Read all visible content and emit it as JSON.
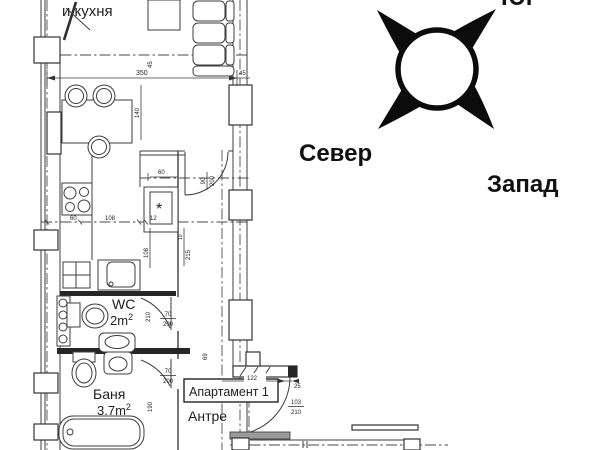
{
  "compass": {
    "north_label": "Север",
    "west_label": "Запад",
    "clipped_top_label": "Юг"
  },
  "plan": {
    "living_kitchen_label": "и кухня",
    "wc": {
      "name": "WC",
      "area_base": "2m",
      "area_exp": "2"
    },
    "bath": {
      "name": "Баня",
      "area_base": "3.7m",
      "area_exp": "2"
    },
    "apartment_label": "Апартамент 1",
    "hall_label": "Антре",
    "shaft_symbol": "*",
    "dims": {
      "total_350": "350",
      "right_45": "45",
      "sofa_45": "45",
      "dining_140": "140",
      "upper_60": "60",
      "living_door_w": "90",
      "living_door_h": "200",
      "kitchen_60": "60",
      "kitchen_108": "108",
      "kitchen_12": "12",
      "shaft_height_108": "108",
      "level_215": "215",
      "level_10": "10",
      "wc_height_210": "210",
      "wc_door_w": "70",
      "wc_door_h": "200",
      "bath_height_190": "190",
      "bath_door_w": "70",
      "bath_door_h": "200",
      "hall_69": "69",
      "entry_122": "122",
      "entry_25": "25",
      "entry_door_w": "103",
      "entry_door_h": "210"
    }
  }
}
